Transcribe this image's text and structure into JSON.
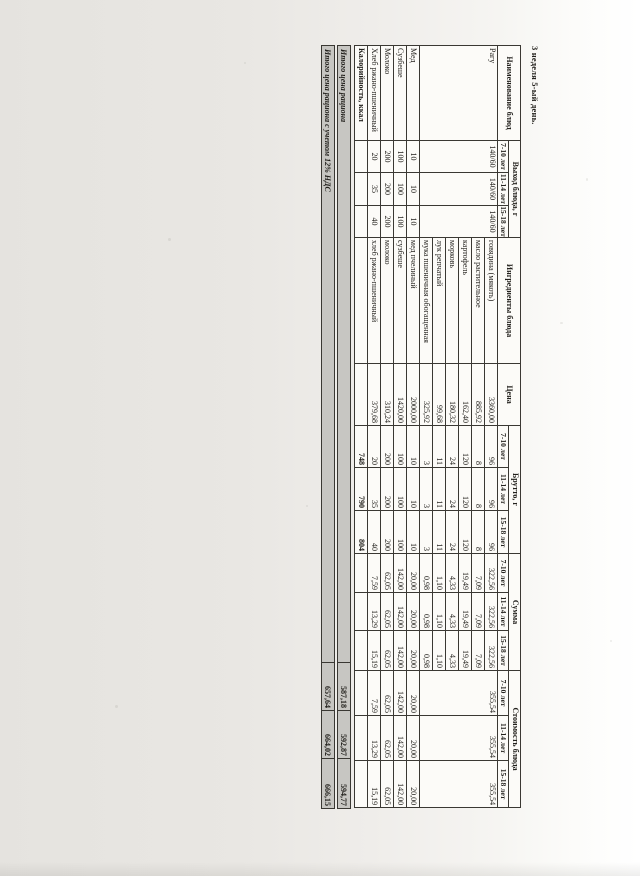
{
  "page_title": "3 неделя 5-ый день.",
  "table": {
    "headers": {
      "dish": "Наименование блюд",
      "output": "Выход блюда, г",
      "ingredients": "Ингредиенты блюда",
      "price": "Цена",
      "gross": "Брутто, г",
      "sum": "Сумма",
      "cost": "Стоимость блюда",
      "ages": [
        "7-10 лет",
        "11-14 лет",
        "15-18 лет"
      ]
    },
    "dishes": [
      {
        "name": "Рагу",
        "output": [
          "140/60",
          "140/60",
          "140/60"
        ],
        "cost": [
          "355,54",
          "355,54",
          "355,54"
        ],
        "ingredients": [
          {
            "name": "говядина (мякоть)",
            "price": "3360,00",
            "gross": [
              "96",
              "96",
              "96"
            ],
            "sum": [
              "322,56",
              "322,56",
              "322,56"
            ]
          },
          {
            "name": "масло растительное",
            "price": "885,92",
            "gross": [
              "8",
              "8",
              "8"
            ],
            "sum": [
              "7,09",
              "7,09",
              "7,09"
            ]
          },
          {
            "name": "картофель",
            "price": "162,40",
            "gross": [
              "120",
              "120",
              "120"
            ],
            "sum": [
              "19,49",
              "19,49",
              "19,49"
            ]
          },
          {
            "name": "морковь",
            "price": "180,32",
            "gross": [
              "24",
              "24",
              "24"
            ],
            "sum": [
              "4,33",
              "4,33",
              "4,33"
            ]
          },
          {
            "name": "лук репчатый",
            "price": "99,68",
            "gross": [
              "11",
              "11",
              "11"
            ],
            "sum": [
              "1,10",
              "1,10",
              "1,10"
            ]
          },
          {
            "name": "мука пшеничная обогащенная",
            "price": "325,92",
            "gross": [
              "3",
              "3",
              "3"
            ],
            "sum": [
              "0,98",
              "0,98",
              "0,98"
            ]
          }
        ]
      },
      {
        "name": "Мед",
        "output": [
          "10",
          "10",
          "10"
        ],
        "cost": [
          "20,00",
          "20,00",
          "20,00"
        ],
        "ingredients": [
          {
            "name": "мед пчелиный",
            "price": "2000,00",
            "gross": [
              "10",
              "10",
              "10"
            ],
            "sum": [
              "20,00",
              "20,00",
              "20,00"
            ]
          }
        ]
      },
      {
        "name": "Сузбеше",
        "output": [
          "100",
          "100",
          "100"
        ],
        "cost": [
          "142,00",
          "142,00",
          "142,00"
        ],
        "ingredients": [
          {
            "name": "сузбеше",
            "price": "1420,00",
            "gross": [
              "100",
              "100",
              "100"
            ],
            "sum": [
              "142,00",
              "142,00",
              "142,00"
            ]
          }
        ]
      },
      {
        "name": "Молоко",
        "output": [
          "200",
          "200",
          "200"
        ],
        "cost": [
          "62,05",
          "62,05",
          "62,05"
        ],
        "ingredients": [
          {
            "name": "молоко",
            "price": "310,24",
            "gross": [
              "200",
              "200",
              "200"
            ],
            "sum": [
              "62,05",
              "62,05",
              "62,05"
            ]
          }
        ]
      },
      {
        "name": "Хлеб ржано-пшеничный",
        "output": [
          "20",
          "35",
          "40"
        ],
        "cost": [
          "7,59",
          "13,29",
          "15,19"
        ],
        "ingredients": [
          {
            "name": "хлеб ржано-пшеничный",
            "price": "379,68",
            "gross": [
              "20",
              "35",
              "40"
            ],
            "sum": [
              "7,59",
              "13,29",
              "15,19"
            ]
          }
        ]
      }
    ],
    "calories": {
      "label": "Калорийность, ккал",
      "values": [
        "748",
        "790",
        "804"
      ]
    }
  },
  "totals": [
    {
      "label": "Итого цена рациона",
      "values": [
        "587,18",
        "592,87",
        "594,77"
      ]
    },
    {
      "label": "Итого цена рациона с учетом 12% НДС",
      "values": [
        "657,64",
        "664,02",
        "666,15"
      ]
    }
  ]
}
